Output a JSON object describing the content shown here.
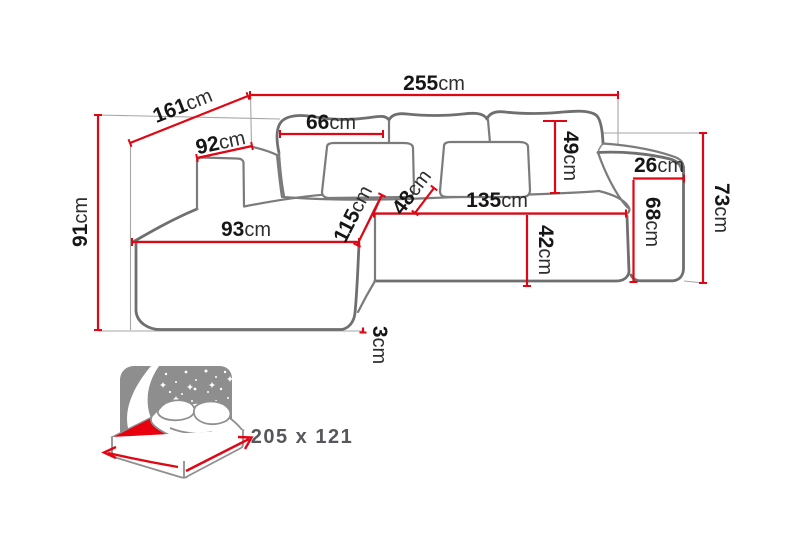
{
  "diagram": {
    "type": "corner-sofa-dimension-diagram",
    "unit": "cm",
    "dimensions": {
      "total_width": {
        "value": "255",
        "unit": "cm"
      },
      "total_depth": {
        "value": "161",
        "unit": "cm"
      },
      "left_armrest_depth": {
        "value": "92",
        "unit": "cm"
      },
      "back_cushion_width": {
        "value": "66",
        "unit": "cm"
      },
      "back_cushion_height": {
        "value": "49",
        "unit": "cm"
      },
      "right_armrest_width": {
        "value": "26",
        "unit": "cm"
      },
      "back_height": {
        "value": "73",
        "unit": "cm"
      },
      "right_armrest_height": {
        "value": "68",
        "unit": "cm"
      },
      "total_height": {
        "value": "91",
        "unit": "cm"
      },
      "chaise_width": {
        "value": "93",
        "unit": "cm"
      },
      "chaise_depth": {
        "value": "115",
        "unit": "cm"
      },
      "seat_depth": {
        "value": "48",
        "unit": "cm"
      },
      "seat_width": {
        "value": "135",
        "unit": "cm"
      },
      "seat_height": {
        "value": "42",
        "unit": "cm"
      },
      "leg_height": {
        "value": "3",
        "unit": "cm"
      }
    },
    "sleeping_area": {
      "label": "205 x 121"
    },
    "colors": {
      "dimension_red": "#e00613",
      "mattress_red": "#e8000f",
      "headboard_gray": "#8e8e8e",
      "outline_gray": "#6f6f6f"
    }
  }
}
